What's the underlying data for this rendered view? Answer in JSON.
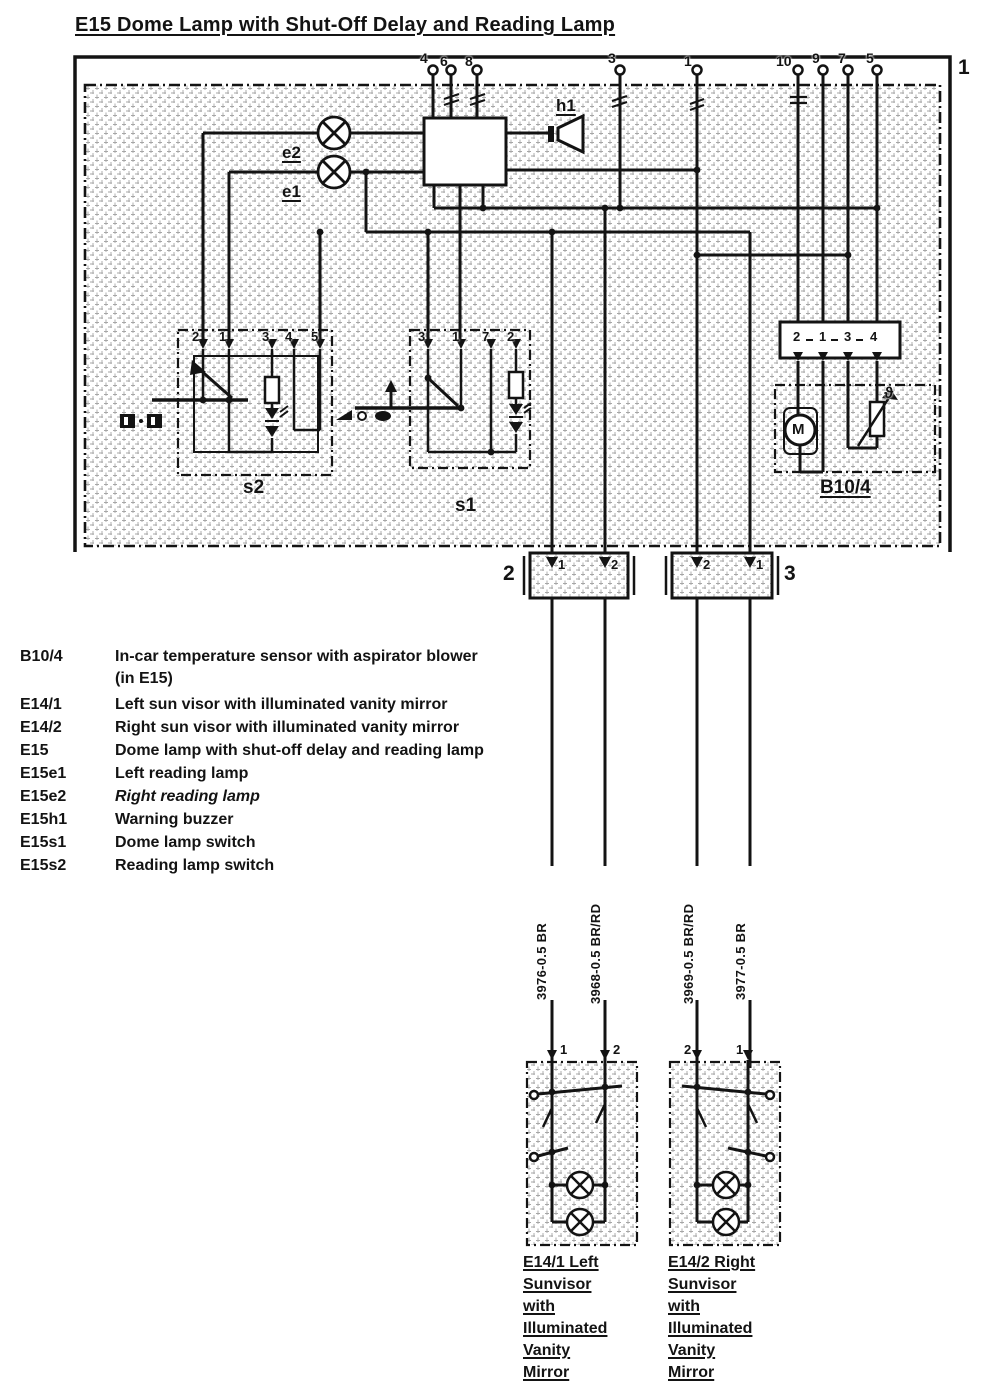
{
  "colors": {
    "ink": "#131313",
    "paper": "#ffffff"
  },
  "page": {
    "number": "1"
  },
  "title": "E15 Dome Lamp with Shut-Off Delay and Reading Lamp",
  "diagram": {
    "top_pins": [
      {
        "label": "4"
      },
      {
        "label": "6"
      },
      {
        "label": "8"
      },
      {
        "label": "3"
      },
      {
        "label": "1"
      },
      {
        "label": "10"
      },
      {
        "label": "9"
      },
      {
        "label": "7"
      },
      {
        "label": "5"
      }
    ],
    "components": {
      "e2": "e2",
      "e1": "e1",
      "h1": "h1",
      "s2": "s2",
      "s1": "s1",
      "b104": "B10/4",
      "motor": "M",
      "theta": "ϑ"
    },
    "s2_pins": [
      "2",
      "1",
      "3",
      "4",
      "5"
    ],
    "s1_pins": [
      "3",
      "1",
      "7",
      "2"
    ],
    "b104_pins": [
      "2",
      "1",
      "3",
      "4"
    ],
    "connector2": {
      "label": "2",
      "pins": [
        "1",
        "2"
      ]
    },
    "connector3": {
      "label": "3",
      "pins": [
        "2",
        "1"
      ]
    },
    "wire_labels": [
      "3976-0.5 BR",
      "3968-0.5 BR/RD",
      "3969-0.5 BR/RD",
      "3977-0.5 BR"
    ],
    "sunvisor_left": {
      "pins": [
        "1",
        "2"
      ],
      "caption_lines": [
        "E14/1 Left",
        "Sunvisor",
        "with",
        "Illuminated",
        "Vanity",
        "Mirror"
      ]
    },
    "sunvisor_right": {
      "pins": [
        "2",
        "1"
      ],
      "caption_lines": [
        "E14/2 Right",
        "Sunvisor",
        "with",
        "Illuminated",
        "Vanity",
        "Mirror"
      ]
    }
  },
  "legend": {
    "rows": [
      {
        "code": "B10/4",
        "desc": "In-car temperature sensor with aspirator blower",
        "desc2": "(in E15)"
      },
      {
        "code": "E14/1",
        "desc": "Left sun visor with illuminated vanity mirror"
      },
      {
        "code": "E14/2",
        "desc": "Right sun visor with illuminated vanity mirror"
      },
      {
        "code": "E15",
        "desc": "Dome lamp with shut-off delay and reading lamp"
      },
      {
        "code": "E15e1",
        "desc": "Left reading lamp"
      },
      {
        "code": "E15e2",
        "desc": "Right reading lamp"
      },
      {
        "code": "E15h1",
        "desc": "Warning buzzer"
      },
      {
        "code": "E15s1",
        "desc": "Dome lamp switch"
      },
      {
        "code": "E15s2",
        "desc": "Reading lamp switch"
      }
    ]
  }
}
